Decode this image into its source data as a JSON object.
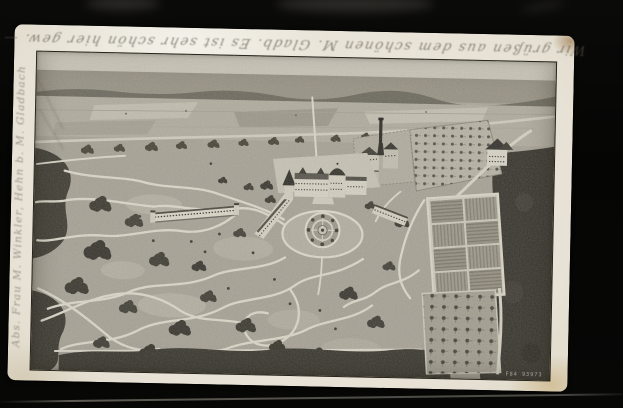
{
  "palette": {
    "scan_background": "#060605",
    "card_paper": "#e9e4d8",
    "print_light": "#dcd7c9",
    "print_mid": "#a6a193",
    "print_dark": "#37342c",
    "pencil": "#565043",
    "corner_stain": "#c6aa70"
  },
  "postcard": {
    "handwriting_top": "Wir grüßen aus dem schönen M. Gladb. Es ist sehr schön hier gew. —",
    "handwriting_left": "Abs. Frau M. Winkler, Hehn b. M. Gladbach",
    "printed_mark": "F84 93973"
  }
}
